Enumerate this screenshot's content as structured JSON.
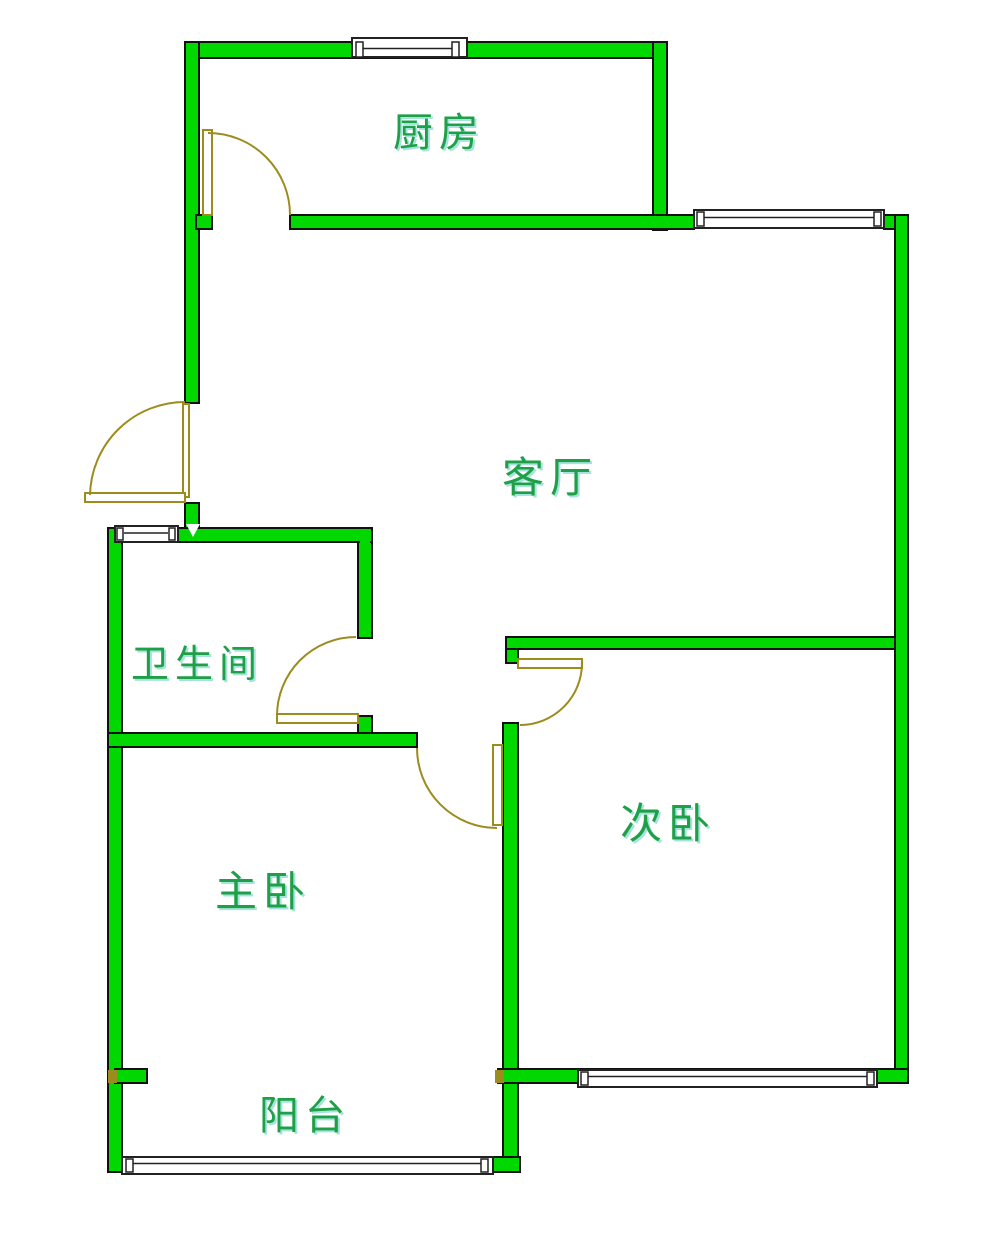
{
  "plan": {
    "type": "apartment-floor-plan",
    "rooms": {
      "kitchen": {
        "label": "厨房"
      },
      "living_room": {
        "label": "客厅"
      },
      "bathroom": {
        "label": "卫生间"
      },
      "master_bedroom": {
        "label": "主卧"
      },
      "second_bedroom": {
        "label": "次卧"
      },
      "balcony": {
        "label": "阳台"
      }
    }
  },
  "colors": {
    "background": "#ffffff",
    "wall-fill": "#00d800",
    "wall-outline": "#111111",
    "window-fill": "#ffffff",
    "window-outline": "#222222",
    "door": "#9c8c1e",
    "label": "#1fa048",
    "label-shadow": "rgba(80,200,190,0.5)"
  }
}
